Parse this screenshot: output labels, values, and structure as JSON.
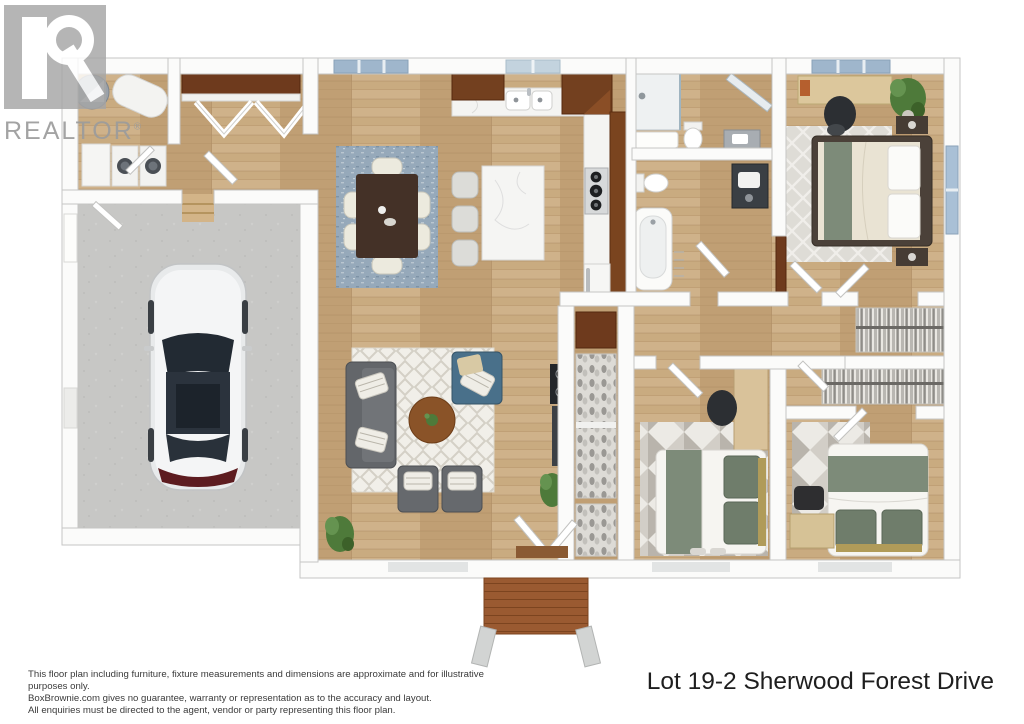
{
  "watermark": {
    "brand": "REALTOR",
    "registered": "®"
  },
  "footer": {
    "disclaimer_lines": [
      "This floor plan including furniture, fixture measurements and dimensions are approximate and for illustrative purposes only.",
      "BoxBrownie.com gives no guarantee, warranty or representation as to the accuracy and layout.",
      "All enquiries must be directed to the agent, vendor or party representing this floor plan."
    ],
    "address": "Lot 19-2 Sherwood Forest Drive"
  },
  "palette": {
    "background": "#ffffff",
    "wood_floor": "#c9ab80",
    "garage_concrete": "#c7c7c5",
    "wall": "#fafaf9",
    "wall_edge": "#c6c6c4",
    "cabinet_wood": "#73401f",
    "deck_wood": "#9a5a31",
    "dining_rug_blue": "#96a9ba",
    "living_rug_white": "#f1efe9",
    "sofa_gray": "#63666a",
    "accent_teal": "#49708a",
    "bedding_green": "#7d8b79",
    "plant_green": "#4e7a3a",
    "marble_counter": "#f4f4f2",
    "window_glass": "#a9c0d6",
    "watermark_gray": "#9c9c9c",
    "text_dark": "#1e1e1e"
  },
  "floor_plan": {
    "style": "3d-rendered top-down floor plan",
    "rooms": [
      "garage",
      "laundry-utility room",
      "entry with coat closet",
      "kitchen",
      "dining area",
      "living room",
      "master bedroom",
      "master bathroom",
      "second bathroom",
      "bedroom 2",
      "bedroom 3",
      "walk-in closet",
      "hallway",
      "hall linen and shoe closets",
      "rear deck"
    ],
    "furniture": [
      "white car",
      "washer and dryer",
      "water heater tanks",
      "dining table with six chairs",
      "kitchen island with three stools",
      "double sink",
      "gas cooktop",
      "gray sofa",
      "teal armchair",
      "two gray armchairs",
      "round coffee table",
      "queen bed with green runner (master)",
      "desk and office chair (master)",
      "bed with green pillows (bedroom 2)",
      "desk and chair (bedroom 2)",
      "bed with green pillows (bedroom 3)",
      "bench (bedroom 3)",
      "walk-in shower",
      "two bathtubs",
      "two toilets",
      "vanities",
      "hanging clothes racks",
      "shoe shelves",
      "potted plants"
    ]
  }
}
